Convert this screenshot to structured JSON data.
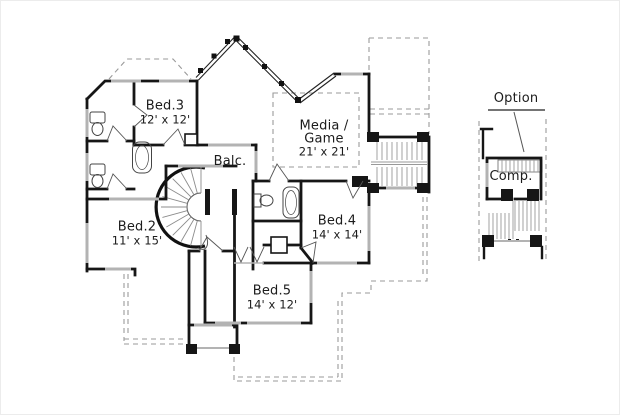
{
  "page": {
    "background": "#ffffff",
    "ink": "#1c1c1c",
    "window_gray": "#b3b3b3",
    "dash_gray": "#9a9a9a",
    "detail_gray": "#8c8c8c"
  },
  "plan": {
    "rooms": [
      {
        "id": "bed3",
        "name": "Bed.3",
        "dims": "12' x 12'"
      },
      {
        "id": "media_game",
        "name": "Media /",
        "name2": "Game",
        "dims": "21' x 21'"
      },
      {
        "id": "balcony",
        "name": "Balc."
      },
      {
        "id": "bed2",
        "name": "Bed.2",
        "dims": "11' x 15'"
      },
      {
        "id": "bed4",
        "name": "Bed.4",
        "dims": "14' x 14'"
      },
      {
        "id": "bed5",
        "name": "Bed.5",
        "dims": "14' x 12'"
      },
      {
        "id": "comp",
        "name": "Comp."
      }
    ],
    "annotations": [
      {
        "id": "option",
        "label": "Option"
      }
    ]
  }
}
